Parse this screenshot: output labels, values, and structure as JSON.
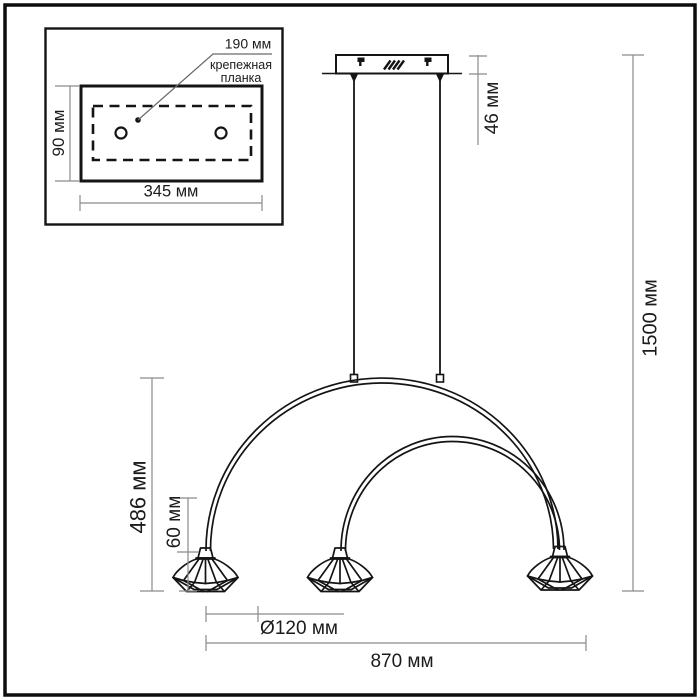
{
  "drawing_type": "pendant-lamp-dimension-diagram",
  "units": "мм",
  "colors": {
    "line": "#141414",
    "dimension_line": "#8a8a8a",
    "text": "#1b1b1b",
    "background": "#ffffff",
    "border": "#0d0d0d"
  },
  "inset": {
    "hole_spacing_label": "190 мм",
    "bracket_label_line1": "крепежная",
    "bracket_label_line2": "планка",
    "plate_height_label": "90 мм",
    "plate_width_label": "345 мм"
  },
  "main": {
    "canopy_height_label": "46 мм",
    "overall_height_label": "1500 мм",
    "arc_drop_label": "486 мм",
    "shade_height_label": "60 мм",
    "shade_diameter_label": "Ø120 мм",
    "overall_width_label": "870 мм"
  }
}
